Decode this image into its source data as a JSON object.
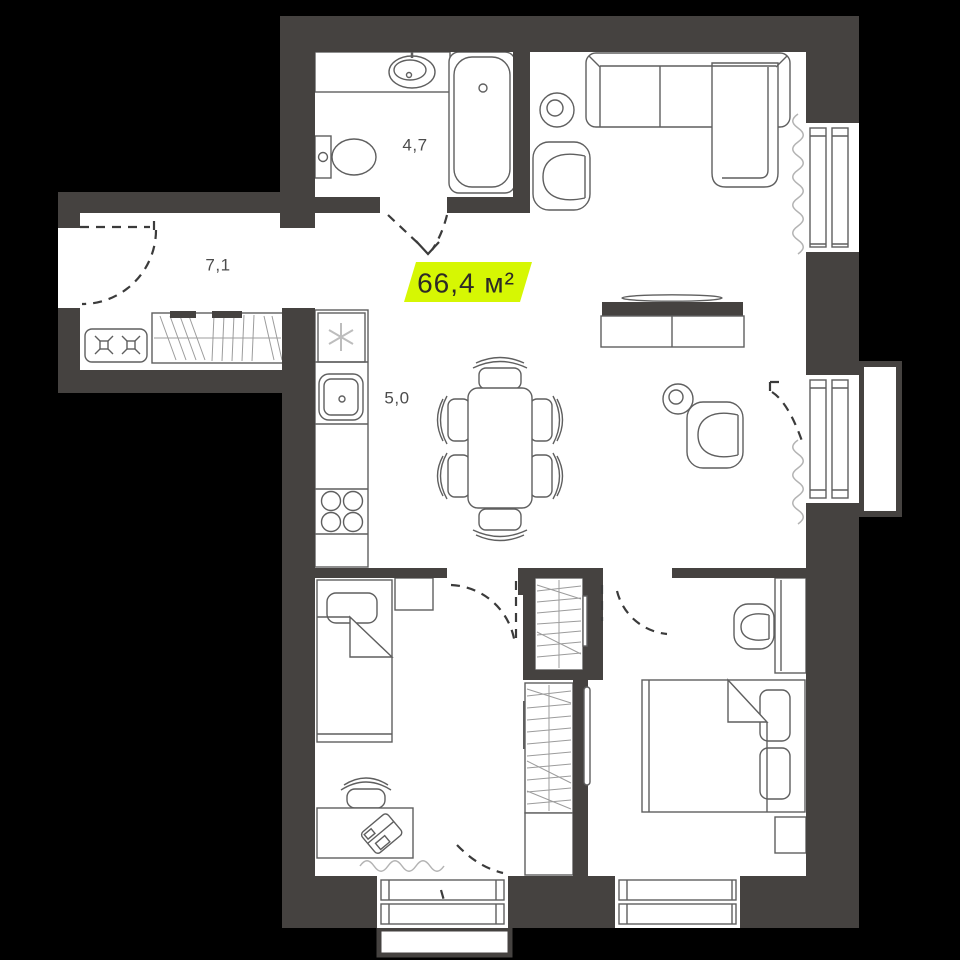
{
  "badge": {
    "total_area": "66,4 м²"
  },
  "rooms": [
    {
      "name": "bathroom",
      "area_label": "4,7"
    },
    {
      "name": "hallway",
      "area_label": "7,1"
    },
    {
      "name": "kitchen",
      "area_label": "5,0"
    }
  ],
  "colors": {
    "background": "#000000",
    "wall": "#454240",
    "floor": "#ffffff",
    "line": "#5f5f5f",
    "line_light": "#8b8b8b",
    "hatch": "#9c9c9c",
    "curtain": "#b3b3b3",
    "appliance": "#bdbdbd",
    "door": "#3b3b3b",
    "label": "#4c4c4c",
    "accent": "#d6f703",
    "badge_text": "#2d2a26"
  }
}
